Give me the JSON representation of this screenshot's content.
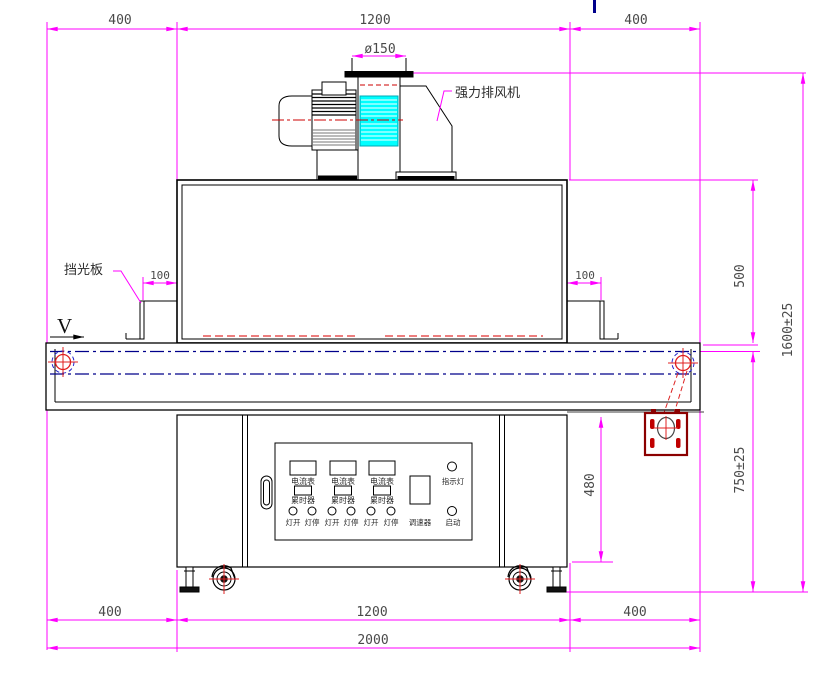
{
  "drawing": {
    "dims_top": [
      "400",
      "1200",
      "400"
    ],
    "duct_diameter": "ø150",
    "dim_100_left": "100",
    "dim_100_right": "100",
    "dim_500": "500",
    "dim_1600": "1600±25",
    "dim_750": "750±25",
    "dim_480": "480",
    "dims_bottom": [
      "400",
      "1200",
      "400"
    ],
    "dim_total": "2000",
    "label_exhaust_fan": "强力排风机",
    "label_light_shield": "挡光板",
    "label_direction": "V"
  },
  "control_panel": {
    "meters": [
      "电流表",
      "电流表",
      "电流表"
    ],
    "timers": [
      "累时器",
      "累时器",
      "累时器"
    ],
    "lamp_buttons": [
      "灯开",
      "灯停",
      "灯开",
      "灯停",
      "灯开",
      "灯停"
    ],
    "speed_controller": "调速器",
    "indicator_light": "指示灯",
    "start_button": "启动"
  },
  "colors": {
    "dimension": "#FF00FF",
    "centerline_red": "#E02020",
    "belt_centerline_blue": "#00008B",
    "fan_cyan": "#00FFFF",
    "plate_dark_red": "#8B0000",
    "outline": "#000000"
  }
}
